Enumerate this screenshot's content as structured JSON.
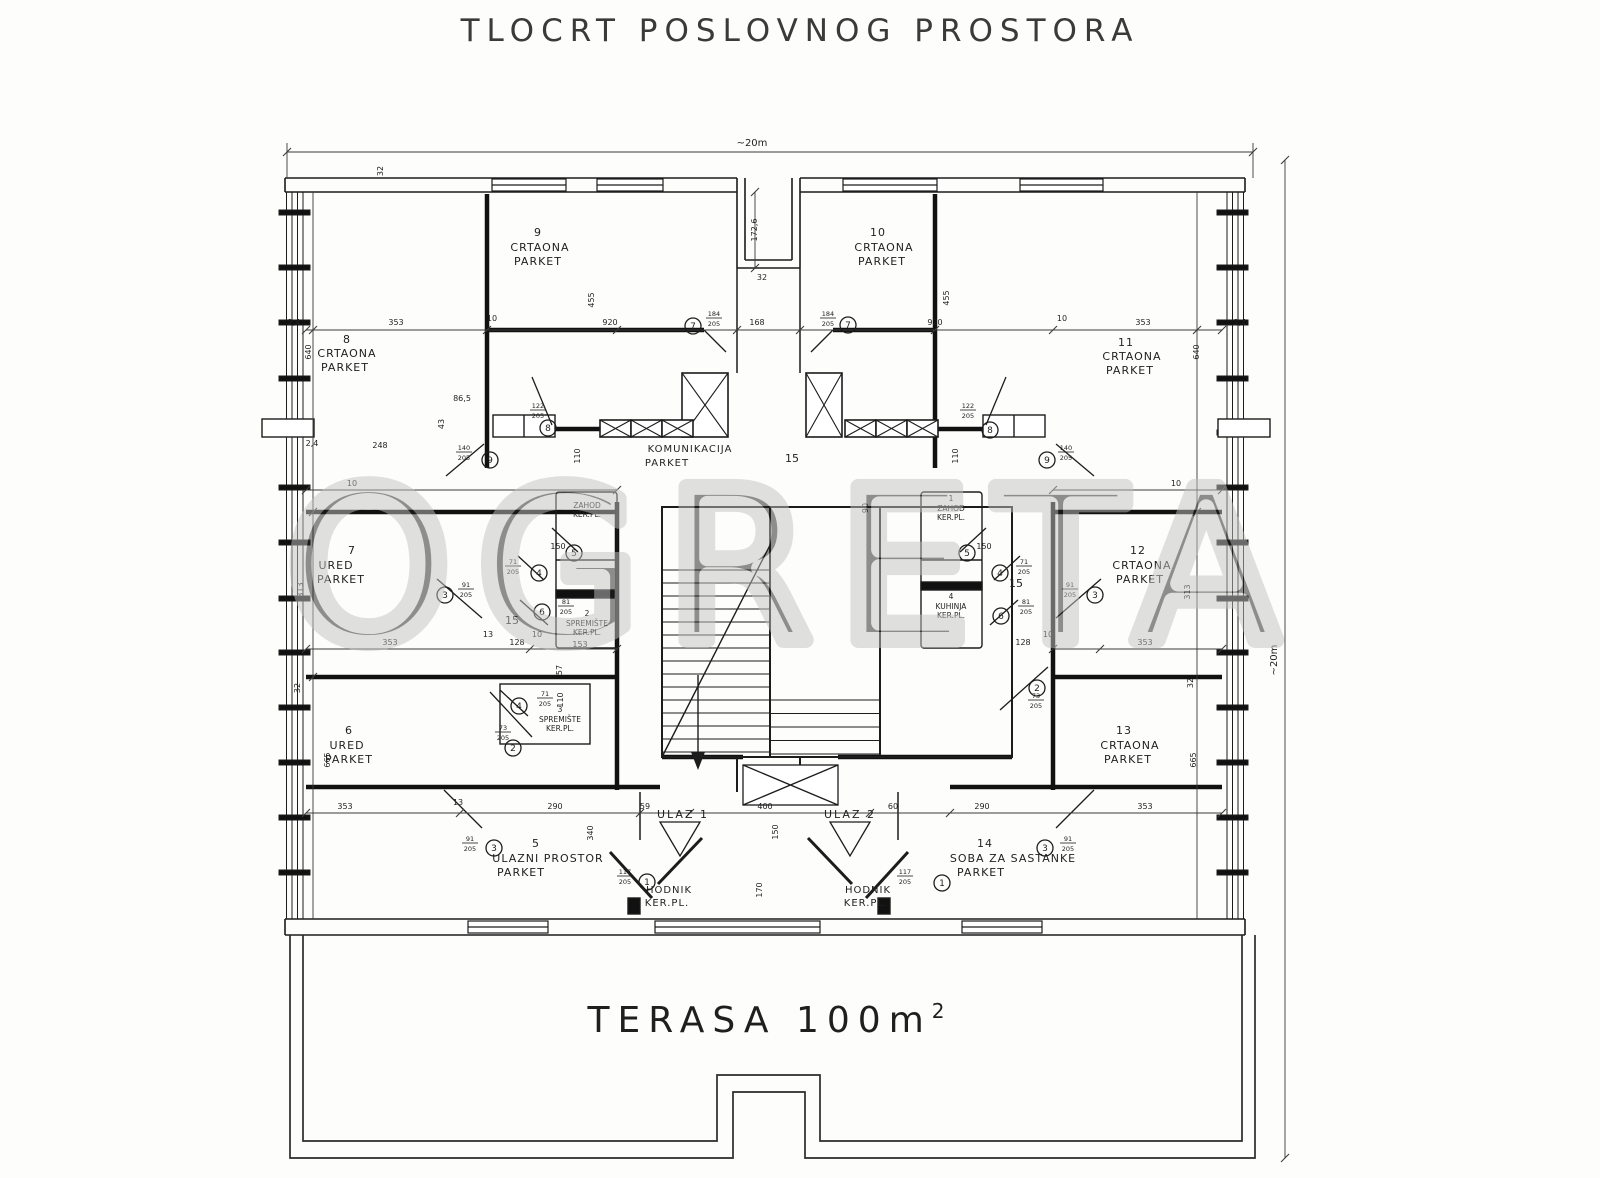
{
  "title": "TLOCRT POSLOVNOG PROSTORA",
  "plan": {
    "watermark": "OGRETA",
    "terrace": {
      "label": "TERASA 100m",
      "sup": "2"
    },
    "rooms": [
      {
        "name": "crtaona-9",
        "fs": 11,
        "lines": [
          {
            "t": "9",
            "x": 538,
            "y": 236
          },
          {
            "t": "CRTAONA",
            "x": 540,
            "y": 251
          },
          {
            "t": "PARKET",
            "x": 538,
            "y": 265
          }
        ]
      },
      {
        "name": "crtaona-10",
        "fs": 11,
        "lines": [
          {
            "t": "10",
            "x": 878,
            "y": 236
          },
          {
            "t": "CRTAONA",
            "x": 884,
            "y": 251
          },
          {
            "t": "PARKET",
            "x": 882,
            "y": 265
          }
        ]
      },
      {
        "name": "crtaona-8",
        "fs": 11,
        "lines": [
          {
            "t": "8",
            "x": 347,
            "y": 343
          },
          {
            "t": "CRTAONA",
            "x": 347,
            "y": 357
          },
          {
            "t": "PARKET",
            "x": 345,
            "y": 371
          }
        ]
      },
      {
        "name": "crtaona-11",
        "fs": 11,
        "lines": [
          {
            "t": "11",
            "x": 1126,
            "y": 346
          },
          {
            "t": "CRTAONA",
            "x": 1132,
            "y": 360
          },
          {
            "t": "PARKET",
            "x": 1130,
            "y": 374
          }
        ]
      },
      {
        "name": "ured-7",
        "fs": 11,
        "lines": [
          {
            "t": "7",
            "x": 352,
            "y": 554
          },
          {
            "t": "URED",
            "x": 336,
            "y": 569
          },
          {
            "t": "PARKET",
            "x": 341,
            "y": 583
          }
        ]
      },
      {
        "name": "crtaona-12",
        "fs": 11,
        "lines": [
          {
            "t": "12",
            "x": 1138,
            "y": 554
          },
          {
            "t": "CRTAONA",
            "x": 1142,
            "y": 569
          },
          {
            "t": "PARKET",
            "x": 1140,
            "y": 583
          }
        ]
      },
      {
        "name": "ured-6",
        "fs": 11,
        "lines": [
          {
            "t": "6",
            "x": 349,
            "y": 734
          },
          {
            "t": "URED",
            "x": 347,
            "y": 749
          },
          {
            "t": "PARKET",
            "x": 349,
            "y": 763
          }
        ]
      },
      {
        "name": "crtaona-13",
        "fs": 11,
        "lines": [
          {
            "t": "13",
            "x": 1124,
            "y": 734
          },
          {
            "t": "CRTAONA",
            "x": 1130,
            "y": 749
          },
          {
            "t": "PARKET",
            "x": 1128,
            "y": 763
          }
        ]
      },
      {
        "name": "ulazni-prostor-5",
        "fs": 11,
        "lines": [
          {
            "t": "5",
            "x": 536,
            "y": 847
          },
          {
            "t": "ULAZNI PROSTOR",
            "x": 548,
            "y": 862
          },
          {
            "t": "PARKET",
            "x": 521,
            "y": 876
          }
        ]
      },
      {
        "name": "soba-za-sastanke-14",
        "fs": 11,
        "lines": [
          {
            "t": "14",
            "x": 985,
            "y": 847
          },
          {
            "t": "SOBA ZA SASTANKE",
            "x": 1013,
            "y": 862
          },
          {
            "t": "PARKET",
            "x": 981,
            "y": 876
          }
        ]
      },
      {
        "name": "komunikacija",
        "fs": 10,
        "lines": [
          {
            "t": "KOMUNIKACIJA",
            "x": 690,
            "y": 452
          },
          {
            "t": "PARKET",
            "x": 667,
            "y": 466
          }
        ]
      },
      {
        "name": "hodnik-left",
        "fs": 10,
        "lines": [
          {
            "t": "HODNIK",
            "x": 669,
            "y": 893
          },
          {
            "t": "KER.PL.",
            "x": 667,
            "y": 906
          }
        ]
      },
      {
        "name": "hodnik-right",
        "fs": 10,
        "lines": [
          {
            "t": "HODNIK",
            "x": 868,
            "y": 893
          },
          {
            "t": "KER.PL.",
            "x": 866,
            "y": 906
          }
        ]
      },
      {
        "name": "ulaz-1",
        "fs": 11,
        "ls": 2,
        "lines": [
          {
            "t": "ULAZ 1",
            "x": 683,
            "y": 818
          }
        ]
      },
      {
        "name": "ulaz-2",
        "fs": 11,
        "ls": 2,
        "lines": [
          {
            "t": "ULAZ 2",
            "x": 850,
            "y": 818
          }
        ]
      },
      {
        "name": "zahod-left",
        "fs": 7.5,
        "ls": 0,
        "lines": [
          {
            "t": "ZAHOD",
            "x": 587,
            "y": 508
          },
          {
            "t": "KER.PL.",
            "x": 587,
            "y": 517
          }
        ]
      },
      {
        "name": "zahod-right",
        "fs": 7.5,
        "ls": 0,
        "lines": [
          {
            "t": "1",
            "x": 951,
            "y": 501
          },
          {
            "t": "ZAHOD",
            "x": 951,
            "y": 511
          },
          {
            "t": "KER.PL.",
            "x": 951,
            "y": 520
          }
        ]
      },
      {
        "name": "kuhinja-right",
        "fs": 7.5,
        "ls": 0,
        "lines": [
          {
            "t": "4",
            "x": 951,
            "y": 599
          },
          {
            "t": "KUHINJA",
            "x": 951,
            "y": 609
          },
          {
            "t": "KER.PL.",
            "x": 951,
            "y": 618
          }
        ]
      },
      {
        "name": "spremiste-2",
        "fs": 7.5,
        "ls": 0,
        "lines": [
          {
            "t": "2",
            "x": 587,
            "y": 616
          },
          {
            "t": "SPREMIŠTE",
            "x": 587,
            "y": 626
          },
          {
            "t": "KER.PL.",
            "x": 587,
            "y": 635
          }
        ]
      },
      {
        "name": "spremiste-3",
        "fs": 7.5,
        "ls": 0,
        "lines": [
          {
            "t": "3",
            "x": 560,
            "y": 712
          },
          {
            "t": "SPREMIŠTE",
            "x": 560,
            "y": 722
          },
          {
            "t": "KER.PL.",
            "x": 560,
            "y": 731
          }
        ]
      }
    ],
    "dimensions": [
      {
        "t": "~20m",
        "x": 752,
        "y": 146,
        "fs": 10
      },
      {
        "t": "32",
        "x": 383,
        "y": 171,
        "r": -90
      },
      {
        "t": "172,6",
        "x": 757,
        "y": 230,
        "r": -90
      },
      {
        "t": "32",
        "x": 762,
        "y": 280
      },
      {
        "t": "2,4",
        "x": 294,
        "y": 325
      },
      {
        "t": "353",
        "x": 396,
        "y": 325
      },
      {
        "t": "10",
        "x": 492,
        "y": 321
      },
      {
        "t": "920",
        "x": 610,
        "y": 325
      },
      {
        "t": "168",
        "x": 757,
        "y": 325
      },
      {
        "t": "920",
        "x": 935,
        "y": 325
      },
      {
        "t": "10",
        "x": 1062,
        "y": 321
      },
      {
        "t": "353",
        "x": 1143,
        "y": 325
      },
      {
        "t": "2,4",
        "x": 1240,
        "y": 325
      },
      {
        "t": "640",
        "x": 311,
        "y": 352,
        "r": -90
      },
      {
        "t": "640",
        "x": 1199,
        "y": 352,
        "r": -90
      },
      {
        "t": "455",
        "x": 594,
        "y": 300,
        "r": -90
      },
      {
        "t": "455",
        "x": 949,
        "y": 298,
        "r": -90
      },
      {
        "t": "86,5",
        "x": 462,
        "y": 401
      },
      {
        "t": "43",
        "x": 444,
        "y": 424,
        "r": -90
      },
      {
        "t": "2,4",
        "x": 312,
        "y": 446
      },
      {
        "t": "248",
        "x": 380,
        "y": 448
      },
      {
        "t": "110",
        "x": 580,
        "y": 456,
        "r": -90
      },
      {
        "t": "110",
        "x": 958,
        "y": 456,
        "r": -90
      },
      {
        "t": "15",
        "x": 792,
        "y": 462,
        "fs": 11
      },
      {
        "t": "15",
        "x": 512,
        "y": 624,
        "fs": 11
      },
      {
        "t": "15",
        "x": 1016,
        "y": 587,
        "fs": 11
      },
      {
        "t": "90",
        "x": 868,
        "y": 508,
        "r": -90
      },
      {
        "t": "150",
        "x": 558,
        "y": 549
      },
      {
        "t": "150",
        "x": 984,
        "y": 549
      },
      {
        "t": "10",
        "x": 352,
        "y": 486
      },
      {
        "t": "10",
        "x": 1176,
        "y": 486
      },
      {
        "t": "313",
        "x": 303,
        "y": 590,
        "r": -90
      },
      {
        "t": "313",
        "x": 1190,
        "y": 592,
        "r": -90
      },
      {
        "t": "57",
        "x": 562,
        "y": 670,
        "r": -90
      },
      {
        "t": "353",
        "x": 390,
        "y": 645
      },
      {
        "t": "13",
        "x": 488,
        "y": 637
      },
      {
        "t": "128",
        "x": 517,
        "y": 645
      },
      {
        "t": "10",
        "x": 537,
        "y": 637
      },
      {
        "t": "153",
        "x": 580,
        "y": 647
      },
      {
        "t": "128",
        "x": 1023,
        "y": 645
      },
      {
        "t": "10",
        "x": 1048,
        "y": 637
      },
      {
        "t": "353",
        "x": 1145,
        "y": 645
      },
      {
        "t": "32",
        "x": 300,
        "y": 688,
        "r": -90
      },
      {
        "t": "32",
        "x": 1193,
        "y": 683,
        "r": -90
      },
      {
        "t": "110",
        "x": 563,
        "y": 700,
        "r": -90
      },
      {
        "t": "665",
        "x": 330,
        "y": 760,
        "r": -90
      },
      {
        "t": "665",
        "x": 1196,
        "y": 760,
        "r": -90
      },
      {
        "t": "353",
        "x": 345,
        "y": 809
      },
      {
        "t": "13",
        "x": 458,
        "y": 805
      },
      {
        "t": "290",
        "x": 555,
        "y": 809
      },
      {
        "t": "59",
        "x": 645,
        "y": 809
      },
      {
        "t": "400",
        "x": 765,
        "y": 809
      },
      {
        "t": "150",
        "x": 778,
        "y": 832,
        "r": -90
      },
      {
        "t": "340",
        "x": 593,
        "y": 833,
        "r": -90
      },
      {
        "t": "60",
        "x": 893,
        "y": 809
      },
      {
        "t": "290",
        "x": 982,
        "y": 809
      },
      {
        "t": "353",
        "x": 1145,
        "y": 809
      },
      {
        "t": "170",
        "x": 762,
        "y": 890,
        "r": -90
      },
      {
        "t": "~20m",
        "x": 1277,
        "y": 660,
        "r": -90,
        "fs": 10
      }
    ],
    "markers": [
      {
        "n": "1",
        "x": 647,
        "y": 882
      },
      {
        "n": "1",
        "x": 942,
        "y": 883
      },
      {
        "n": "2",
        "x": 513,
        "y": 748
      },
      {
        "n": "2",
        "x": 1037,
        "y": 688
      },
      {
        "n": "3",
        "x": 445,
        "y": 595
      },
      {
        "n": "3",
        "x": 1095,
        "y": 595
      },
      {
        "n": "3",
        "x": 494,
        "y": 848
      },
      {
        "n": "3",
        "x": 1045,
        "y": 848
      },
      {
        "n": "4",
        "x": 539,
        "y": 573
      },
      {
        "n": "4",
        "x": 1000,
        "y": 573
      },
      {
        "n": "4",
        "x": 519,
        "y": 706
      },
      {
        "n": "5",
        "x": 574,
        "y": 553
      },
      {
        "n": "5",
        "x": 967,
        "y": 553
      },
      {
        "n": "6",
        "x": 542,
        "y": 612
      },
      {
        "n": "6",
        "x": 1001,
        "y": 616
      },
      {
        "n": "7",
        "x": 693,
        "y": 326
      },
      {
        "n": "7",
        "x": 848,
        "y": 325
      },
      {
        "n": "8",
        "x": 548,
        "y": 428
      },
      {
        "n": "8",
        "x": 990,
        "y": 430
      },
      {
        "n": "9",
        "x": 490,
        "y": 460
      },
      {
        "n": "9",
        "x": 1047,
        "y": 460
      }
    ],
    "door_tags": [
      {
        "top": "140",
        "bot": "205",
        "x": 464,
        "y": 452
      },
      {
        "top": "122",
        "bot": "205",
        "x": 538,
        "y": 410
      },
      {
        "top": "184",
        "bot": "205",
        "x": 714,
        "y": 318
      },
      {
        "top": "71",
        "bot": "205",
        "x": 513,
        "y": 566
      },
      {
        "top": "81",
        "bot": "205",
        "x": 566,
        "y": 606
      },
      {
        "top": "91",
        "bot": "205",
        "x": 466,
        "y": 589
      },
      {
        "top": "73",
        "bot": "205",
        "x": 503,
        "y": 732
      },
      {
        "top": "71",
        "bot": "205",
        "x": 545,
        "y": 698
      },
      {
        "top": "117",
        "bot": "205",
        "x": 625,
        "y": 876
      },
      {
        "top": "91",
        "bot": "205",
        "x": 470,
        "y": 843
      },
      {
        "top": "140",
        "bot": "205",
        "x": 1066,
        "y": 452
      },
      {
        "top": "122",
        "bot": "205",
        "x": 968,
        "y": 410
      },
      {
        "top": "184",
        "bot": "205",
        "x": 828,
        "y": 318
      },
      {
        "top": "71",
        "bot": "205",
        "x": 1024,
        "y": 566
      },
      {
        "top": "81",
        "bot": "205",
        "x": 1026,
        "y": 606
      },
      {
        "top": "91",
        "bot": "205",
        "x": 1070,
        "y": 589
      },
      {
        "top": "73",
        "bot": "205",
        "x": 1036,
        "y": 700
      },
      {
        "top": "117",
        "bot": "205",
        "x": 905,
        "y": 876
      },
      {
        "top": "91",
        "bot": "205",
        "x": 1068,
        "y": 843
      }
    ]
  }
}
